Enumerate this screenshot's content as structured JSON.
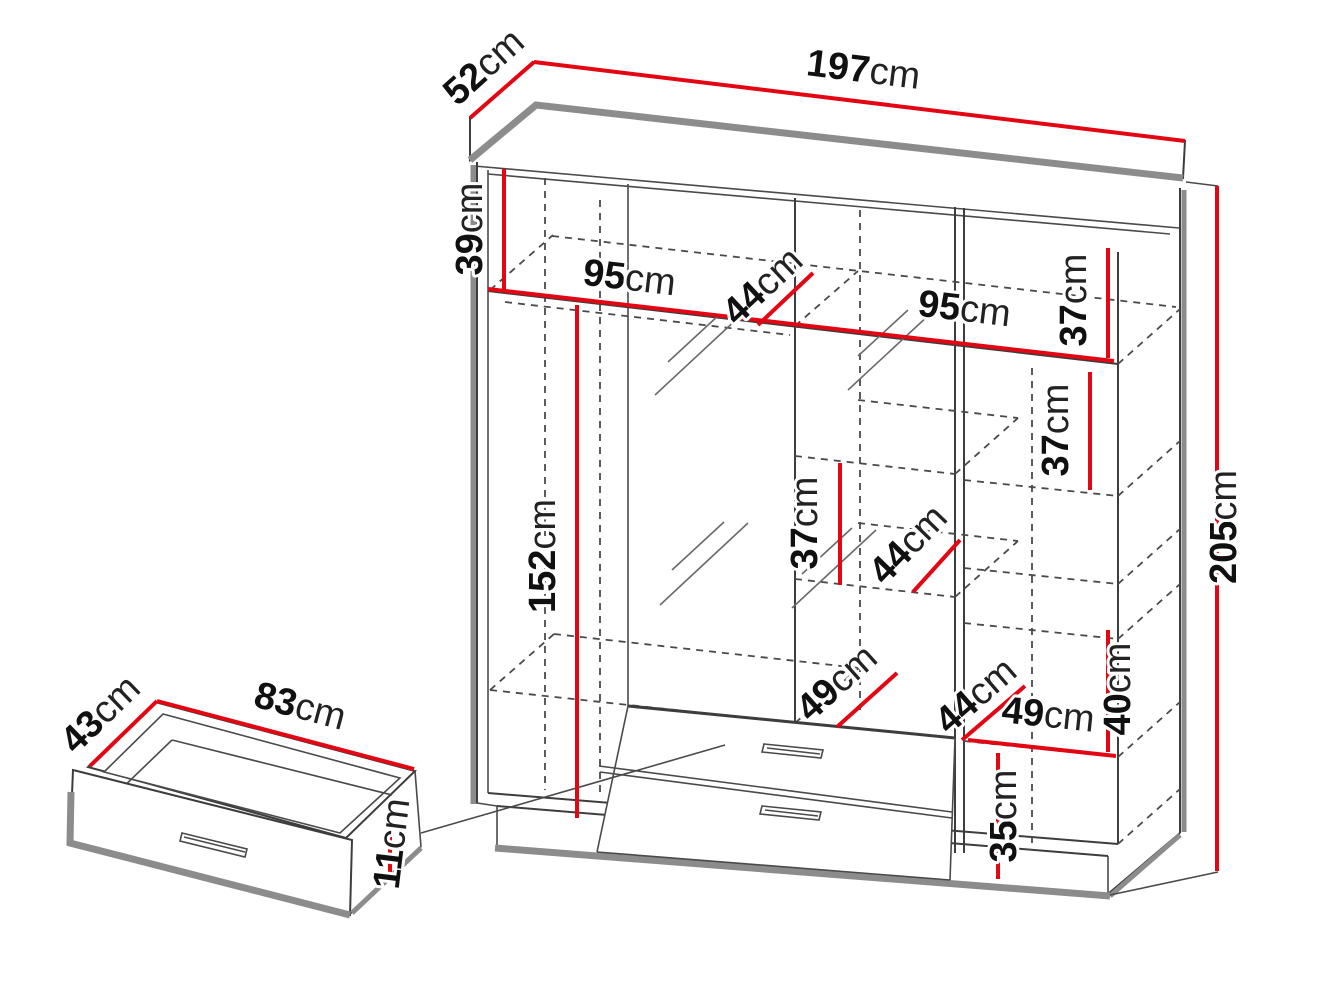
{
  "page": {
    "background": "#ffffff",
    "type": "furniture dimension diagram"
  },
  "colors": {
    "dimension_red": "#e30613",
    "line_dark": "#3d3d3d",
    "shadow_grey": "#8c8c8c",
    "text_black": "#101010"
  },
  "wardrobe": {
    "dimensions": {
      "top_depth": {
        "value": "52",
        "unit": "cm"
      },
      "top_width": {
        "value": "197",
        "unit": "cm"
      },
      "height": {
        "value": "205",
        "unit": "cm"
      },
      "top_shelf_drop": {
        "value": "39",
        "unit": "cm"
      },
      "left_section_width": {
        "value": "95",
        "unit": "cm"
      },
      "top_hanging_depth": {
        "value": "44",
        "unit": "cm"
      },
      "right_section_width": {
        "value": "95",
        "unit": "cm"
      },
      "right_shelf_gap_1": {
        "value": "37",
        "unit": "cm"
      },
      "right_shelf_gap_2": {
        "value": "37",
        "unit": "cm"
      },
      "middle_shelf_gap": {
        "value": "37",
        "unit": "cm"
      },
      "middle_shelf_depth": {
        "value": "44",
        "unit": "cm"
      },
      "hanging_height": {
        "value": "152",
        "unit": "cm"
      },
      "bottom_shelf_depth": {
        "value": "49",
        "unit": "cm"
      },
      "bottom_right_depth": {
        "value": "44",
        "unit": "cm"
      },
      "bottom_right_width": {
        "value": "49",
        "unit": "cm"
      },
      "right_lower_gap": {
        "value": "40",
        "unit": "cm"
      },
      "bottom_right_height": {
        "value": "35",
        "unit": "cm"
      }
    }
  },
  "drawer": {
    "dimensions": {
      "depth": {
        "value": "43",
        "unit": "cm"
      },
      "width": {
        "value": "83",
        "unit": "cm"
      },
      "height": {
        "value": "11",
        "unit": "cm"
      }
    }
  }
}
